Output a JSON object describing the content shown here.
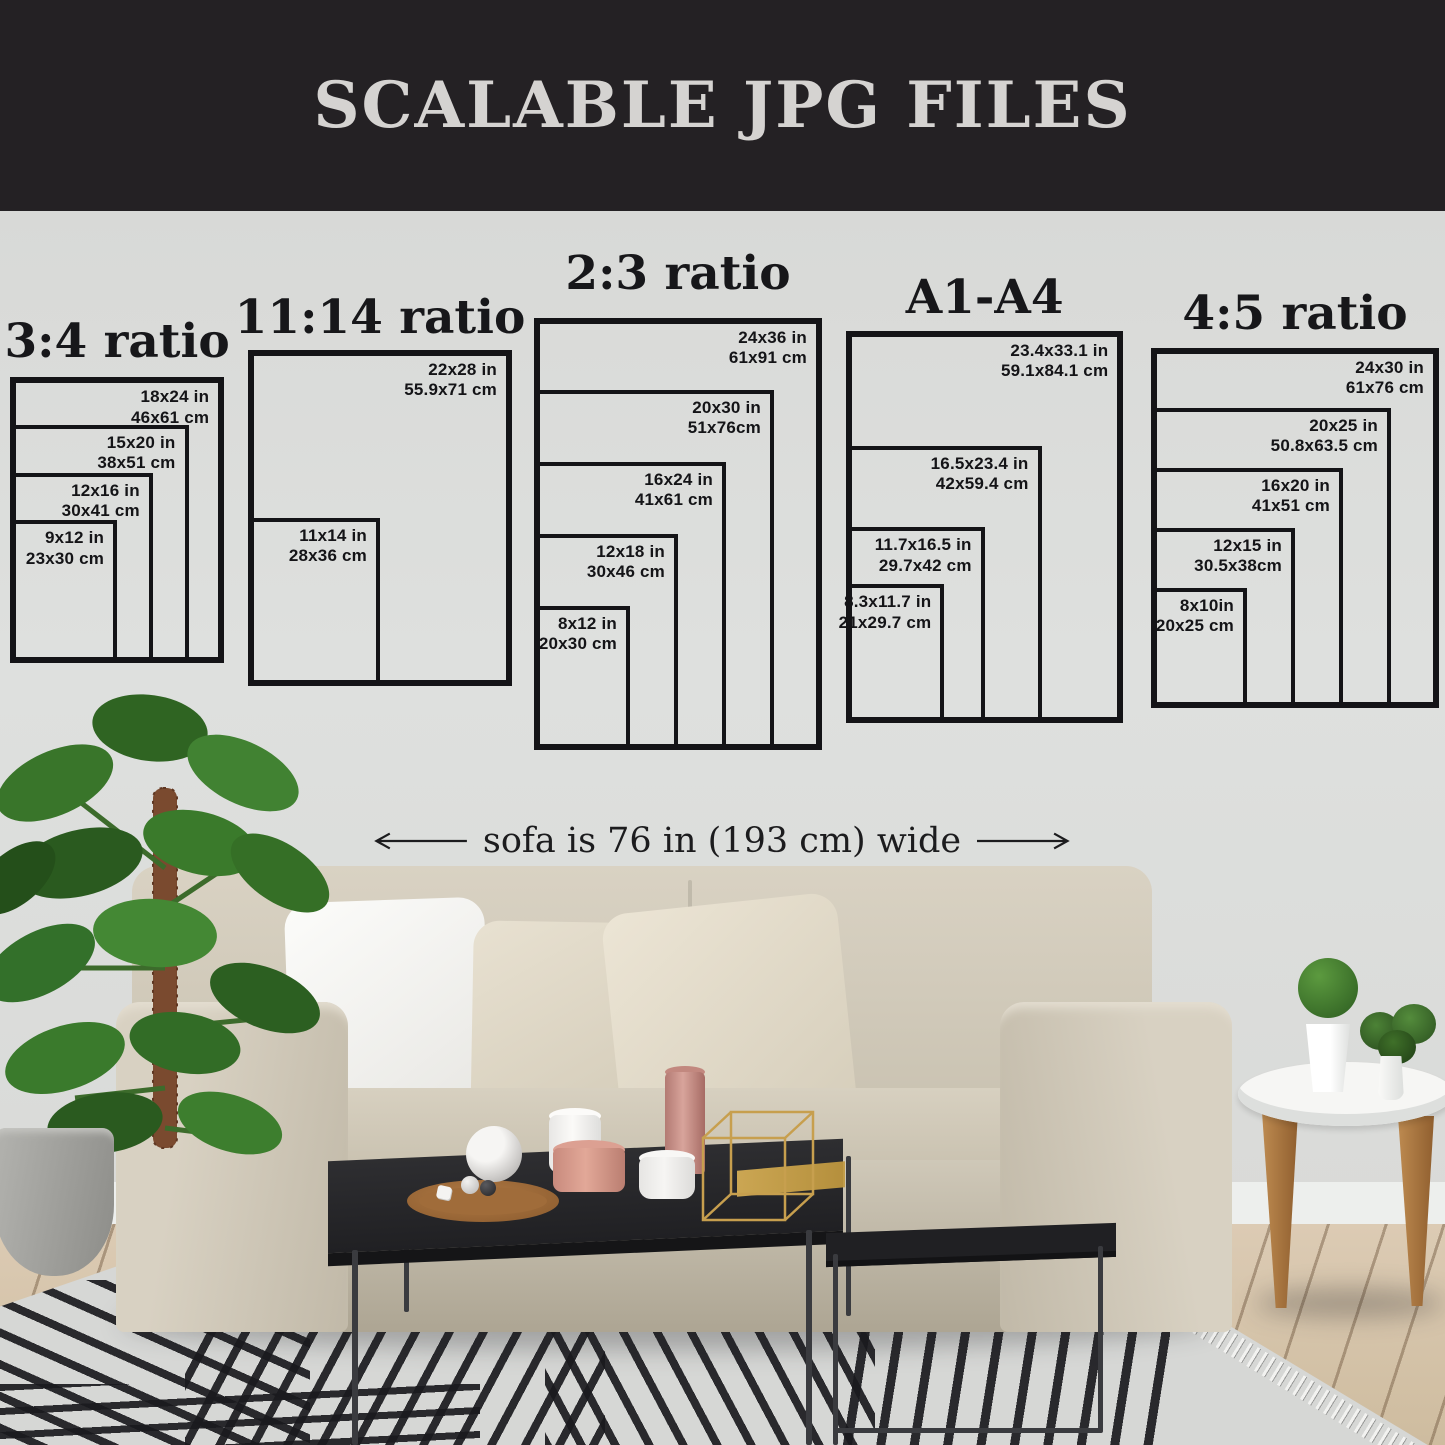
{
  "banner": {
    "title": "SCALABLE JPG FILES",
    "bg_color": "#242124",
    "text_color": "#d5d3d1"
  },
  "annotation": {
    "text": "sofa is 76 in (193 cm) wide"
  },
  "diagram": {
    "line_color": "#141417",
    "wall_color": "#dcdddb"
  },
  "groups": [
    {
      "title": "3:4 ratio",
      "left": 10,
      "bottom": 663,
      "ppi": 11.9,
      "title_top": 314,
      "sizes": [
        {
          "inches": "18x24 in",
          "cm": "46x61 cm",
          "w": 18,
          "h": 24
        },
        {
          "inches": "15x20 in",
          "cm": "38x51 cm",
          "w": 15,
          "h": 20
        },
        {
          "inches": "12x16 in",
          "cm": "30x41 cm",
          "w": 12,
          "h": 16
        },
        {
          "inches": "9x12 in",
          "cm": "23x30 cm",
          "w": 9,
          "h": 12
        }
      ]
    },
    {
      "title": "11:14 ratio",
      "left": 248,
      "bottom": 686,
      "ppi": 12,
      "title_top": 290,
      "sizes": [
        {
          "inches": "22x28 in",
          "cm": "55.9x71 cm",
          "w": 22,
          "h": 28
        },
        {
          "inches": "11x14 in",
          "cm": "28x36 cm",
          "w": 11,
          "h": 14
        }
      ]
    },
    {
      "title": "2:3 ratio",
      "left": 534,
      "bottom": 750,
      "ppi": 12,
      "title_top": 246,
      "sizes": [
        {
          "inches": "24x36 in",
          "cm": "61x91 cm",
          "w": 24,
          "h": 36
        },
        {
          "inches": "20x30 in",
          "cm": "51x76cm",
          "w": 20,
          "h": 30
        },
        {
          "inches": "16x24 in",
          "cm": "41x61 cm",
          "w": 16,
          "h": 24
        },
        {
          "inches": "12x18 in",
          "cm": "30x46 cm",
          "w": 12,
          "h": 18
        },
        {
          "inches": "8x12 in",
          "cm": "20x30 cm",
          "w": 8,
          "h": 12
        }
      ]
    },
    {
      "title": "A1-A4",
      "left": 846,
      "bottom": 723,
      "ppi": 11.85,
      "title_top": 270,
      "sizes": [
        {
          "inches": "23.4x33.1 in",
          "cm": "59.1x84.1 cm",
          "w": 23.4,
          "h": 33.1
        },
        {
          "inches": "16.5x23.4 in",
          "cm": "42x59.4 cm",
          "w": 16.5,
          "h": 23.4
        },
        {
          "inches": "11.7x16.5 in",
          "cm": "29.7x42 cm",
          "w": 11.7,
          "h": 16.5
        },
        {
          "inches": "8.3x11.7 in",
          "cm": "21x29.7 cm",
          "w": 8.3,
          "h": 11.7
        }
      ]
    },
    {
      "title": "4:5 ratio",
      "left": 1151,
      "bottom": 708,
      "ppi": 12,
      "title_top": 286,
      "sizes": [
        {
          "inches": "24x30 in",
          "cm": "61x76 cm",
          "w": 24,
          "h": 30
        },
        {
          "inches": "20x25 in",
          "cm": "50.8x63.5 cm",
          "w": 20,
          "h": 25
        },
        {
          "inches": "16x20 in",
          "cm": "41x51 cm",
          "w": 16,
          "h": 20
        },
        {
          "inches": "12x15 in",
          "cm": "30.5x38cm",
          "w": 12,
          "h": 15
        },
        {
          "inches": "8x10in",
          "cm": "20x25 cm",
          "w": 8,
          "h": 10
        }
      ]
    }
  ]
}
